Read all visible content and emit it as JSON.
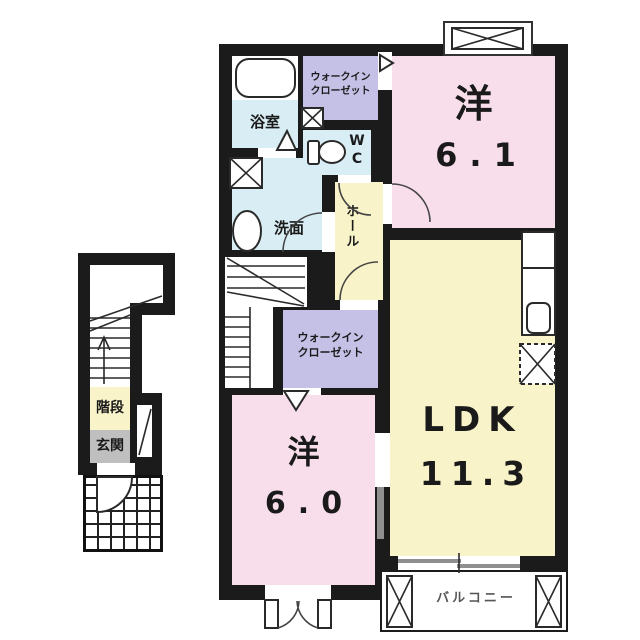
{
  "rooms": {
    "bedroom1": {
      "label": "洋",
      "size": "6.1"
    },
    "ldk": {
      "label": "LDK",
      "size": "11.3"
    },
    "bedroom2": {
      "label": "洋",
      "size": "6.0"
    },
    "bathroom": {
      "label": "浴室"
    },
    "washroom": {
      "label": "洗面"
    },
    "wc": {
      "line1": "W",
      "line2": "C"
    },
    "hall": {
      "label": "ホール"
    },
    "walkin_closet_top": {
      "line1": "ウォークイン",
      "line2": "クローゼット"
    },
    "walkin_closet_mid": {
      "line1": "ウォークイン",
      "line2": "クローゼット"
    },
    "balcony": {
      "label": "バルコニー"
    },
    "stairs": {
      "label": "階段"
    },
    "entrance": {
      "label": "玄関"
    }
  },
  "colors": {
    "room_pink": "#f8deea",
    "room_yellow": "#f8f3c9",
    "wet_area_blue": "#d8edf4",
    "closet_purple": "#c4c0e6",
    "entrance_gray": "#bfbfbf",
    "wall_black": "#1b1b1b"
  }
}
